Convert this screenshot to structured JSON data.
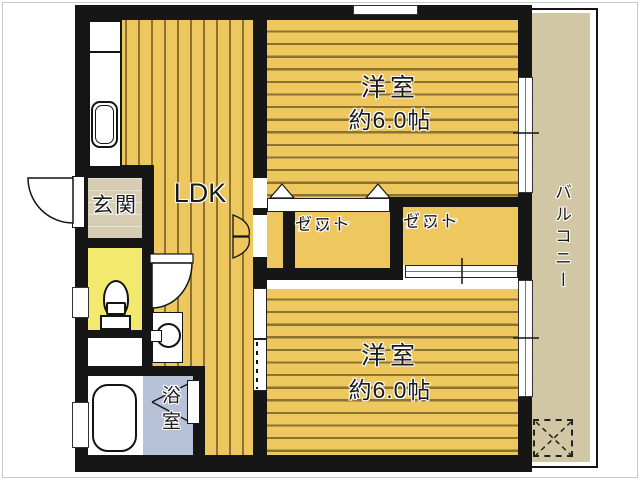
{
  "title": "apartment floor plan",
  "rooms": {
    "ldk": {
      "label": "LDK"
    },
    "entrance": {
      "label": "玄関"
    },
    "bedroom_top": {
      "name": "洋室",
      "size": "約6.0帖"
    },
    "bedroom_bottom": {
      "name": "洋室",
      "size": "約6.0帖"
    },
    "closet_left": {
      "line1": "クロー",
      "line2": "ゼット"
    },
    "closet_right": {
      "line1": "クロー",
      "line2": "ゼット"
    },
    "bathroom": {
      "label": "浴室"
    },
    "balcony": {
      "label": "バルコニー"
    }
  },
  "fixtures": [
    "kitchen-sink",
    "toilet",
    "bathtub",
    "washing-machine",
    "entry-door",
    "toilet-door",
    "bifold-closet-door",
    "bath-folding-door",
    "closet-folding-door-triangles",
    "sliding-door",
    "sliding-window",
    "evacuation-hatch",
    "balcony-railing"
  ],
  "colors": {
    "wall": "#161616",
    "floor_wood": "#eec85e",
    "floor_stripe": "#3c2c088c",
    "entrance_floor": "#d6cdb3",
    "toilet_floor": "#f2e96e",
    "bath_floor": "#b7c2d8",
    "balcony_floor": "#d2c7a4"
  }
}
